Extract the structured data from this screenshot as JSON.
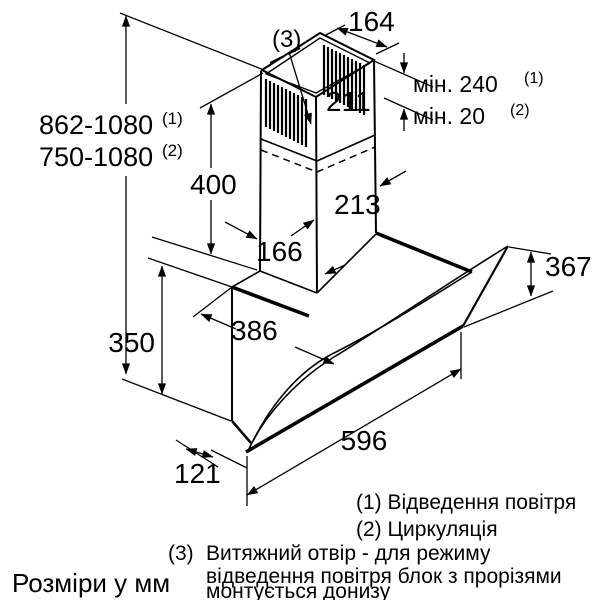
{
  "figure": {
    "title_note": "Розміри у мм",
    "labels": {
      "top_width": "164",
      "upper_duct_width": "211",
      "lower_duct_width": "213",
      "duct_depth": "166",
      "chimney_height": "400",
      "glass_height": "367",
      "body_height": "350",
      "body_depth": "386",
      "hood_width": "596",
      "bottom_depth": "121",
      "min_clearance_exhaust": "мін. 240",
      "min_clearance_exhaust_sup": "(1)",
      "min_clearance_recirc": "мін. 20",
      "min_clearance_recirc_sup": "(2)",
      "height_range_exhaust": "862-1080",
      "height_range_exhaust_sup": "(1)",
      "height_range_recirc": "750-1080",
      "height_range_recirc_sup": "(2)",
      "slot_ref": "(3)"
    },
    "legend": {
      "item1": "(1) Відведення повітря",
      "item2": "(2) Циркуляція",
      "item3_num": "(3)",
      "item3_line1": "Витяжний отвір - для режиму",
      "item3_line2": "відведення повітря блок з прорізями",
      "item3_line3": "монтується донизу"
    },
    "colors": {
      "line": "#000000",
      "background": "#ffffff"
    }
  }
}
